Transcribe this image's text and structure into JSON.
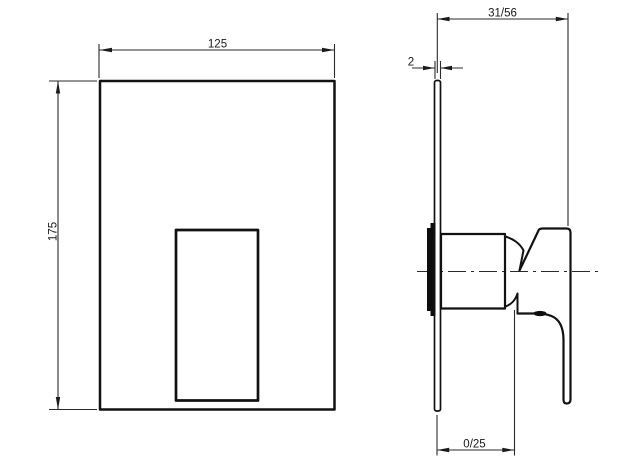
{
  "drawing": {
    "background": "#ffffff",
    "line_color": "#121212",
    "dimension_line_color": "#2b2b2b",
    "dimensions": {
      "front_width": "125",
      "front_height": "175",
      "projection": "31/56",
      "plate_thickness": "2",
      "recess": "0/25"
    }
  }
}
